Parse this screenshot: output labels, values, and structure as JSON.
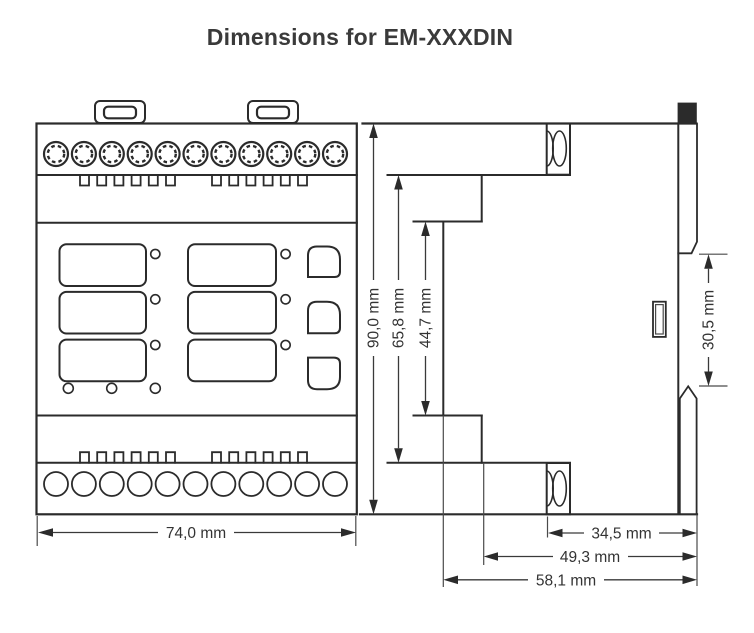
{
  "title": "Dimensions for EM-XXXDIN",
  "unit": "mm",
  "front_view": {
    "name": "front view",
    "width_label": "74,0 mm",
    "top_terminal_count": 11,
    "bottom_terminal_count": 11,
    "display_window_count": 6,
    "button_count": 3
  },
  "side_view": {
    "name": "side view",
    "overall_height_label": "90,0 mm",
    "mid_height_label": "65,8 mm",
    "inner_height_label": "44,7 mm",
    "rail_section_label": "30,5 mm",
    "depth_to_terminal_label": "34,5 mm",
    "depth_mid_label": "49,3 mm",
    "depth_overall_label": "58,1 mm"
  },
  "colors": {
    "background": "#ffffff",
    "outline": "#2b2b2b",
    "dimension_line": "#3a3a3a",
    "label_text": "#333333",
    "din_clip_fill": "#2b2b2b"
  }
}
